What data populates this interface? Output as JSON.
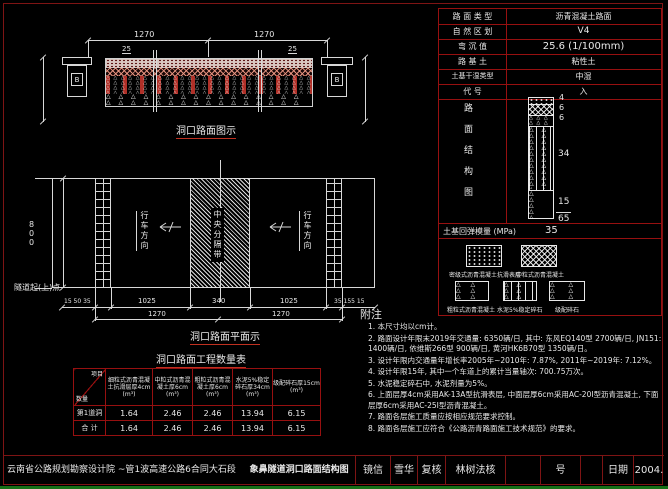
{
  "colors": {
    "frame_red": "#7e1414",
    "table_red": "#971010",
    "accent_red": "#c03020",
    "line_white": "#e8e8e8",
    "green_bar": "#167016",
    "dowel_red": "#b03028"
  },
  "section_view": {
    "title": "洞口路面图示",
    "dim_left": "1270",
    "dim_right": "1270",
    "offset_left": "25",
    "offset_right": "25",
    "duct_label_left": "B",
    "duct_label_right": "B"
  },
  "plan_view": {
    "title": "洞口路面平面示",
    "center_strip_label": "中央分隔带",
    "direction_left": "行车方向",
    "direction_right": "行车方向",
    "height_dim": "800",
    "origin_label": "隧道起(上)点",
    "dims_row1": [
      "15 50 35",
      "1025",
      "340",
      "1025",
      "35 155 15"
    ],
    "dims_row2": [
      "1270",
      "1270"
    ]
  },
  "quantity_table": {
    "title": "洞口路面工程数量表",
    "corner_top": "项目",
    "corner_bottom": "数量",
    "unit": "(m³)",
    "columns": [
      "细粒式沥青混凝土抗滑层厚4cm",
      "中粒式沥青混凝土厚6cm",
      "粗粒式沥青混凝土厚6cm",
      "水泥5%稳定碎石厚34cm",
      "级配碎石厚15cm"
    ],
    "rows": [
      {
        "label": "第1道洞",
        "v1": "1.64",
        "v2": "2.46",
        "v3": "2.46",
        "v4": "13.94",
        "v5": "6.15"
      },
      {
        "label": "合 计",
        "v1": "1.64",
        "v2": "2.46",
        "v3": "2.46",
        "v4": "13.94",
        "v5": "6.15"
      }
    ]
  },
  "param_table": {
    "rows": [
      {
        "label": "路 面 类 型",
        "value": "沥青混凝土路面"
      },
      {
        "label": "自 然 区 划",
        "value": "V4"
      },
      {
        "label": "弯 沉 值",
        "value": "25.6 (1/100mm)"
      },
      {
        "label": "路 基 土",
        "value": "粘性土"
      },
      {
        "label": "土基干湿类型",
        "value": "中湿"
      },
      {
        "label": "代 号",
        "value": "入"
      }
    ],
    "structure_label": "路面结构图",
    "layers": [
      {
        "thickness": "4"
      },
      {
        "thickness": "6"
      },
      {
        "thickness": "6"
      },
      {
        "thickness": "34"
      },
      {
        "thickness": "15"
      }
    ],
    "total_thickness": "65",
    "modulus_label": "土基回弹模量 (MPa)",
    "modulus_value": "35"
  },
  "legend": {
    "items": [
      {
        "label": "密级式沥青混凝土抗滑表层"
      },
      {
        "label": "中粒式沥青混凝土"
      },
      {
        "label": "粗粒式沥青混凝土"
      },
      {
        "label": "水泥5%稳定碎石"
      },
      {
        "label": "级配碎石"
      }
    ]
  },
  "notes": {
    "heading": "附注",
    "items": [
      "1. 本尺寸均以cm计。",
      "2. 路面设计年限末2019年交通量: 6350辆/日, 其中: 东风EQ140型 2700辆/日, JN151: 1400辆/日, 依维斯266型 900辆/日, 黄河HK6B70型 1350辆/日。",
      "3. 设计年限内交通量年增长率2005年~2010年: 7.87%, 2011年~2019年: 7.12%。",
      "4. 设计年限15年, 其中一个车道上的累计当量轴次: 700.75万次。",
      "5. 水泥稳定碎石中, 水泥剂量为5%。",
      "6. 上面层厚4cm采用AK-13A型抗滑表层, 中面层厚6cm采用AC-20Ⅰ型沥青混凝土, 下面层厚6cm采用AC-25Ⅰ型沥青混凝土。",
      "7. 路面各层施工质量应按相应规范要求控制。",
      "8. 路面各层施工应符合《公路沥青路面施工技术规范》的要求。"
    ]
  },
  "title_bar": {
    "project": "云南省公路规划勘察设计院 ~管1波高速公路6合同大石段",
    "drawing": "象鼻隧道洞口路面结构图",
    "cells": [
      "镜信",
      "雪华",
      "复核",
      "林树法核",
      "",
      "号",
      "",
      "日期",
      "2004."
    ]
  }
}
